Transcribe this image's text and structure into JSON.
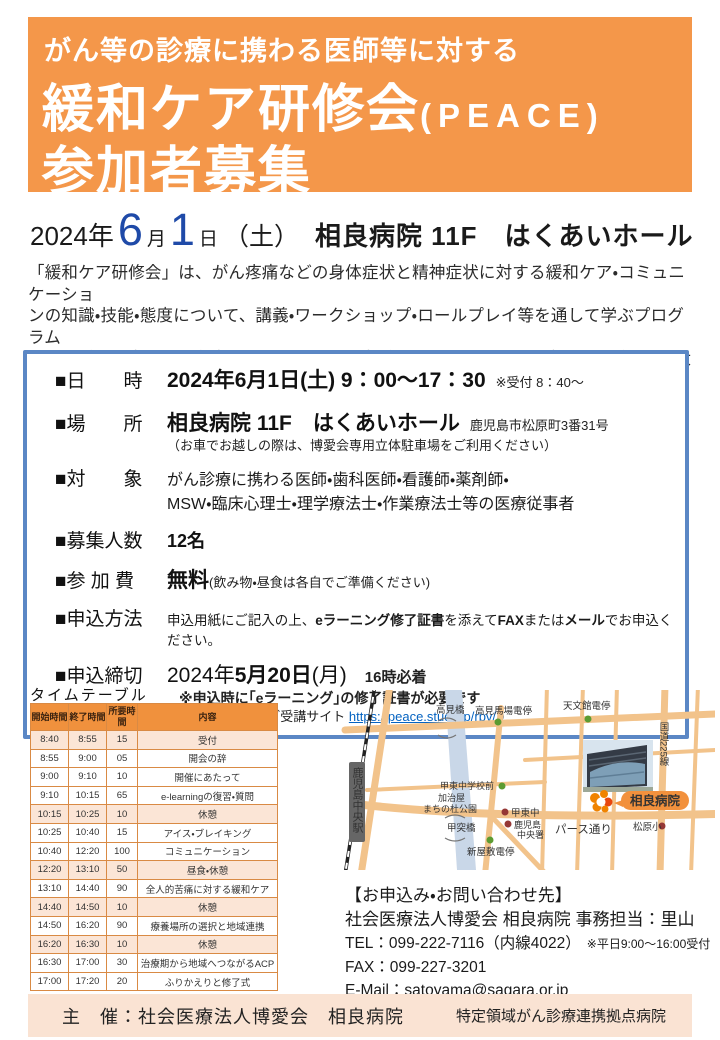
{
  "header": {
    "subtitle": "がん等の診療に携わる医師等に対する",
    "title_main": "緩和ケア研修会",
    "title_paren": "(PEACE)",
    "title_line3": "参加者募集"
  },
  "dateline": {
    "year": "2024年",
    "month_num": "6",
    "month_unit": "月",
    "day_num": "1",
    "day_unit": "日",
    "dow": "（土）",
    "venue": "相良病院 11F　はくあいホール"
  },
  "intro_lines": [
    "「緩和ケア研修会」は、がん疼痛などの身体症状と精神症状に対する緩和ケア・コミュニケーショ",
    "ンの知識・技能・態度について、講義・ワークショップ・ロールプレイ等を通して学ぶプログラム",
    "です。がん医療は特に多職種によるチーム医療が重要であると共に、地域連携がとても大切です。",
    "職種間・地域のチーム力を高めるプログラムに、ぜひご参加ください。"
  ],
  "details": {
    "datetime": {
      "label": "■日　　時",
      "value": "2024年6月1日(土)  9：00～17：30",
      "note": "※受付 8：40～"
    },
    "place": {
      "label": "■場　　所",
      "value": "相良病院 11F　はくあいホール",
      "address": "鹿児島市松原町3番31号",
      "note": "（お車でお越しの際は、博愛会専用立体駐車場をご利用ください）"
    },
    "target": {
      "label": "■対　　象",
      "line1": "がん診療に携わる医師・歯科医師・看護師・薬剤師・",
      "line2": "MSW・臨床心理士・理学療法士・作業療法士等の医療従事者"
    },
    "capacity": {
      "label": "■募集人数",
      "value": "12名"
    },
    "fee": {
      "label": "■参 加 費",
      "value": "無料",
      "note": "(飲み物・昼食は各自でご準備ください)"
    },
    "apply": {
      "label": "■申込方法",
      "pre": "申込用紙にご記入の上、",
      "bold1": "eラーニング修了証書",
      "mid1": "を添えて",
      "bold2": "FAX",
      "mid2": "または",
      "bold3": "メール",
      "post": "でお申込ください。"
    },
    "deadline": {
      "label": "■申込締切",
      "value_pre": "2024年",
      "value_bold": "5月20日",
      "value_post": "(月)",
      "time_note": "16時必着",
      "note2": "※申込時に｢eラーニング｣の修了証書が必要です",
      "note3_pre": "（eラーニング受講サイト",
      "url": "https://peace.study.jp/rpv/",
      "note3_post": "）"
    }
  },
  "timetable": {
    "title": "タイムテーブル",
    "headers": [
      "開始時間",
      "終了時間",
      "所要時間",
      "内容"
    ],
    "rows": [
      {
        "start": "8:40",
        "end": "8:55",
        "dur": "15",
        "content": "受付"
      },
      {
        "start": "8:55",
        "end": "9:00",
        "dur": "05",
        "content": "開会の辞"
      },
      {
        "start": "9:00",
        "end": "9:10",
        "dur": "10",
        "content": "開催にあたって"
      },
      {
        "start": "9:10",
        "end": "10:15",
        "dur": "65",
        "content": "e-learningの復習・質問"
      },
      {
        "start": "10:15",
        "end": "10:25",
        "dur": "10",
        "content": "休憩"
      },
      {
        "start": "10:25",
        "end": "10:40",
        "dur": "15",
        "content": "アイス・ブレイキング"
      },
      {
        "start": "10:40",
        "end": "12:20",
        "dur": "100",
        "content": "コミュニケーション"
      },
      {
        "start": "12:20",
        "end": "13:10",
        "dur": "50",
        "content": "昼食・休憩"
      },
      {
        "start": "13:10",
        "end": "14:40",
        "dur": "90",
        "content": "全人的苦痛に対する緩和ケア"
      },
      {
        "start": "14:40",
        "end": "14:50",
        "dur": "10",
        "content": "休憩"
      },
      {
        "start": "14:50",
        "end": "16:20",
        "dur": "90",
        "content": "療養場所の選択と地域連携"
      },
      {
        "start": "16:20",
        "end": "16:30",
        "dur": "10",
        "content": "休憩"
      },
      {
        "start": "16:30",
        "end": "17:00",
        "dur": "30",
        "content": "治療期から地域へつながるACP"
      },
      {
        "start": "17:00",
        "end": "17:20",
        "dur": "20",
        "content": "ふりかえりと修了式"
      }
    ]
  },
  "map": {
    "station": "鹿児島中央駅",
    "takami_bridge": "高見橋",
    "takamibaba_stop": "高見馬場電停",
    "tenmonkan_stop": "天文館電停",
    "route225": "国道225線",
    "koto_school_front": "甲東中学校前",
    "kajiya_park1": "加治屋",
    "kajiya_park2": "まちの杜公園",
    "koto_junior": "甲東中",
    "police1": "鹿児島",
    "police2": "中央署",
    "kotsuki_bridge": "甲突橋",
    "shinyashiki_stop": "新屋敷電停",
    "pearth_street": "パース通り",
    "matsubara_elem": "松原小",
    "hospital_badge": "相良病院"
  },
  "contact": {
    "heading": "【お申込み・お問い合わせ先】",
    "org": "社会医療法人博愛会 相良病院 事務担当：里山",
    "tel": "TEL：099-222-7116（内線4022）",
    "tel_note": "※平日9:00～16:00受付",
    "fax": "FAX：099-227-3201",
    "email": "E-Mail：satoyama@sagara.or.jp"
  },
  "footer": {
    "left": "主　催：社会医療法人博愛会　相良病院",
    "right": "特定領域がん診療連携拠点病院"
  },
  "colors": {
    "accent_orange": "#F4974A",
    "table_header_orange": "#F0913D",
    "row_highlight_peach": "#FBE5D6",
    "box_border_blue": "#5B87C5",
    "date_number_blue": "#1F4AA8",
    "link_blue": "#0563C1",
    "footer_bg": "#FAE3D3",
    "badge_orange": "#F2913D"
  }
}
